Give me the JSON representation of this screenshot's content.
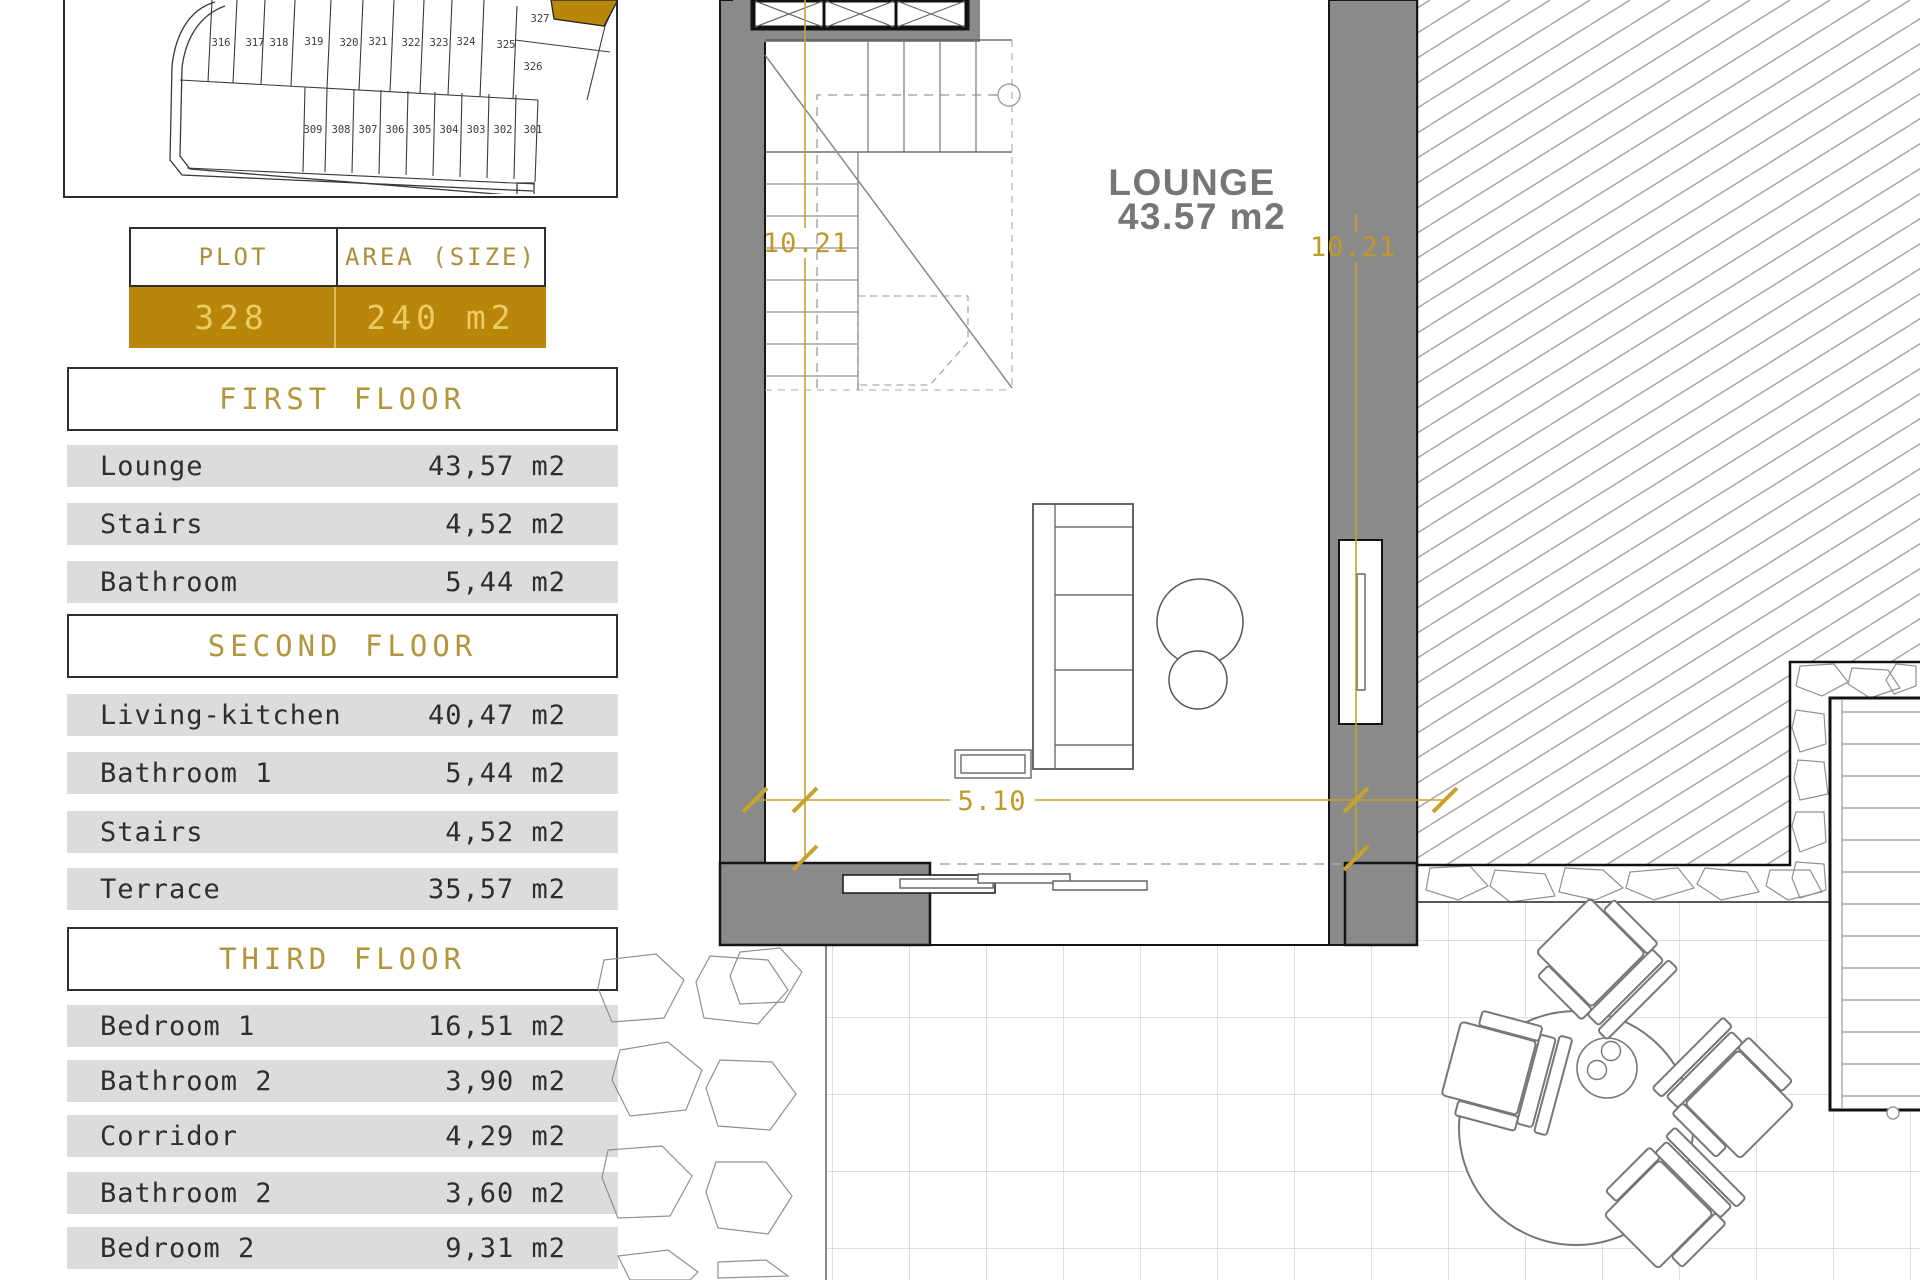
{
  "site_plan": {
    "upper_plots": [
      "316",
      "317",
      "318",
      "319",
      "320",
      "321",
      "322",
      "323",
      "324",
      "325"
    ],
    "corner_plots": [
      "327",
      "326"
    ],
    "lower_plots": [
      "309",
      "308",
      "307",
      "306",
      "305",
      "304",
      "303",
      "302",
      "301"
    ],
    "highlight_color": "#b8860b"
  },
  "plot_table": {
    "col1_header": "PLOT",
    "col2_header": "AREA (SIZE)",
    "plot_number": "328",
    "area": "240 m2"
  },
  "floors": [
    {
      "title": "FIRST FLOOR",
      "rows": [
        {
          "label": "Lounge",
          "value": "43,57 m2"
        },
        {
          "label": "Stairs",
          "value": "4,52 m2"
        },
        {
          "label": "Bathroom",
          "value": "5,44 m2"
        }
      ]
    },
    {
      "title": "SECOND FLOOR",
      "rows": [
        {
          "label": "Living-kitchen",
          "value": "40,47 m2"
        },
        {
          "label": "Bathroom 1",
          "value": "5,44 m2"
        },
        {
          "label": "Stairs",
          "value": "4,52 m2"
        },
        {
          "label": "Terrace",
          "value": "35,57 m2"
        }
      ]
    },
    {
      "title": "THIRD FLOOR",
      "rows": [
        {
          "label": "Bedroom 1",
          "value": "16,51 m2"
        },
        {
          "label": "Bathroom 2",
          "value": "3,90 m2"
        },
        {
          "label": "Corridor",
          "value": "4,29 m2"
        },
        {
          "label": "Bathroom 2",
          "value": "3,60 m2"
        },
        {
          "label": "Bedroom 2",
          "value": "9,31 m2"
        }
      ]
    }
  ],
  "plan": {
    "room_label": "LOUNGE",
    "room_area": "43.57 m2",
    "dim_left": "10.21",
    "dim_right": "10.21",
    "dim_bottom": "5.10",
    "dim_color": "#c8a22c",
    "wall_color": "#8a8a8a"
  }
}
